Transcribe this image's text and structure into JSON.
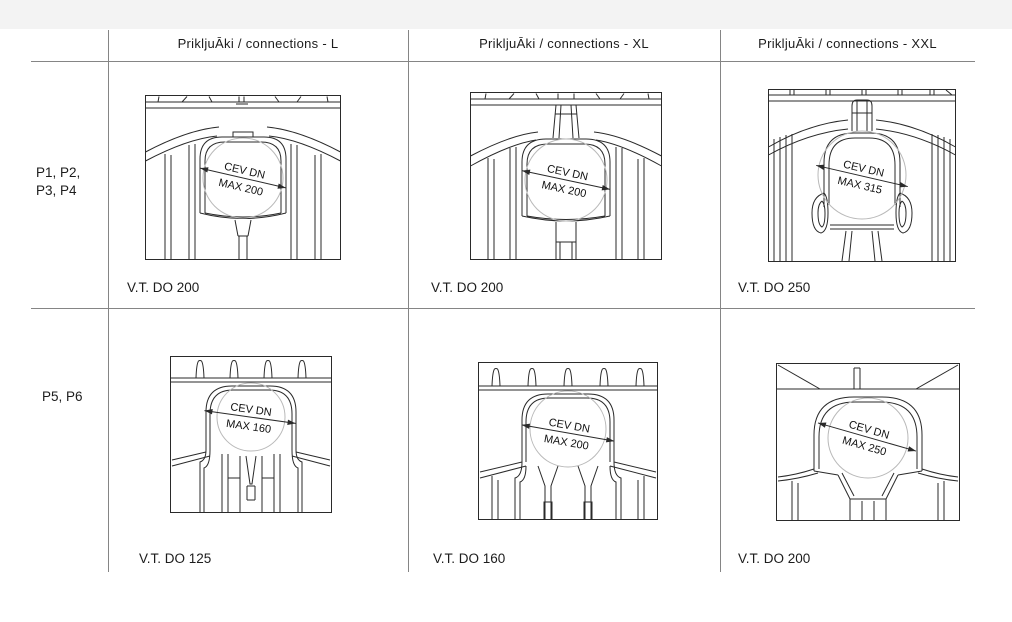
{
  "page": {
    "background": "#ffffff",
    "top_band_color": "#f3f3f3",
    "grid_line_color": "#858585",
    "drawing_line_color": "#2a2a2a"
  },
  "table": {
    "columns": [
      {
        "id": "L",
        "header": "PrikljuĀki / connections - L"
      },
      {
        "id": "XL",
        "header": "PrikljuĀki / connections - XL"
      },
      {
        "id": "XXL",
        "header": "PrikljuĀki / connections - XXL"
      }
    ],
    "rows": [
      {
        "id": "row1",
        "label": "P1, P2,\nP3, P4",
        "cells": [
          {
            "dim_line1": "CEV DN",
            "dim_line2": "MAX 200",
            "caption": "V.T. DO 200"
          },
          {
            "dim_line1": "CEV DN",
            "dim_line2": "MAX 200",
            "caption": "V.T. DO 200"
          },
          {
            "dim_line1": "CEV DN",
            "dim_line2": "MAX 315",
            "caption": "V.T. DO 250"
          }
        ]
      },
      {
        "id": "row2",
        "label": "P5, P6",
        "cells": [
          {
            "dim_line1": "CEV DN",
            "dim_line2": "MAX 160",
            "caption": "V.T. DO 125"
          },
          {
            "dim_line1": "CEV DN",
            "dim_line2": "MAX 200",
            "caption": "V.T. DO 160"
          },
          {
            "dim_line1": "CEV DN",
            "dim_line2": "MAX 250",
            "caption": "V.T. DO 200"
          }
        ]
      }
    ]
  }
}
